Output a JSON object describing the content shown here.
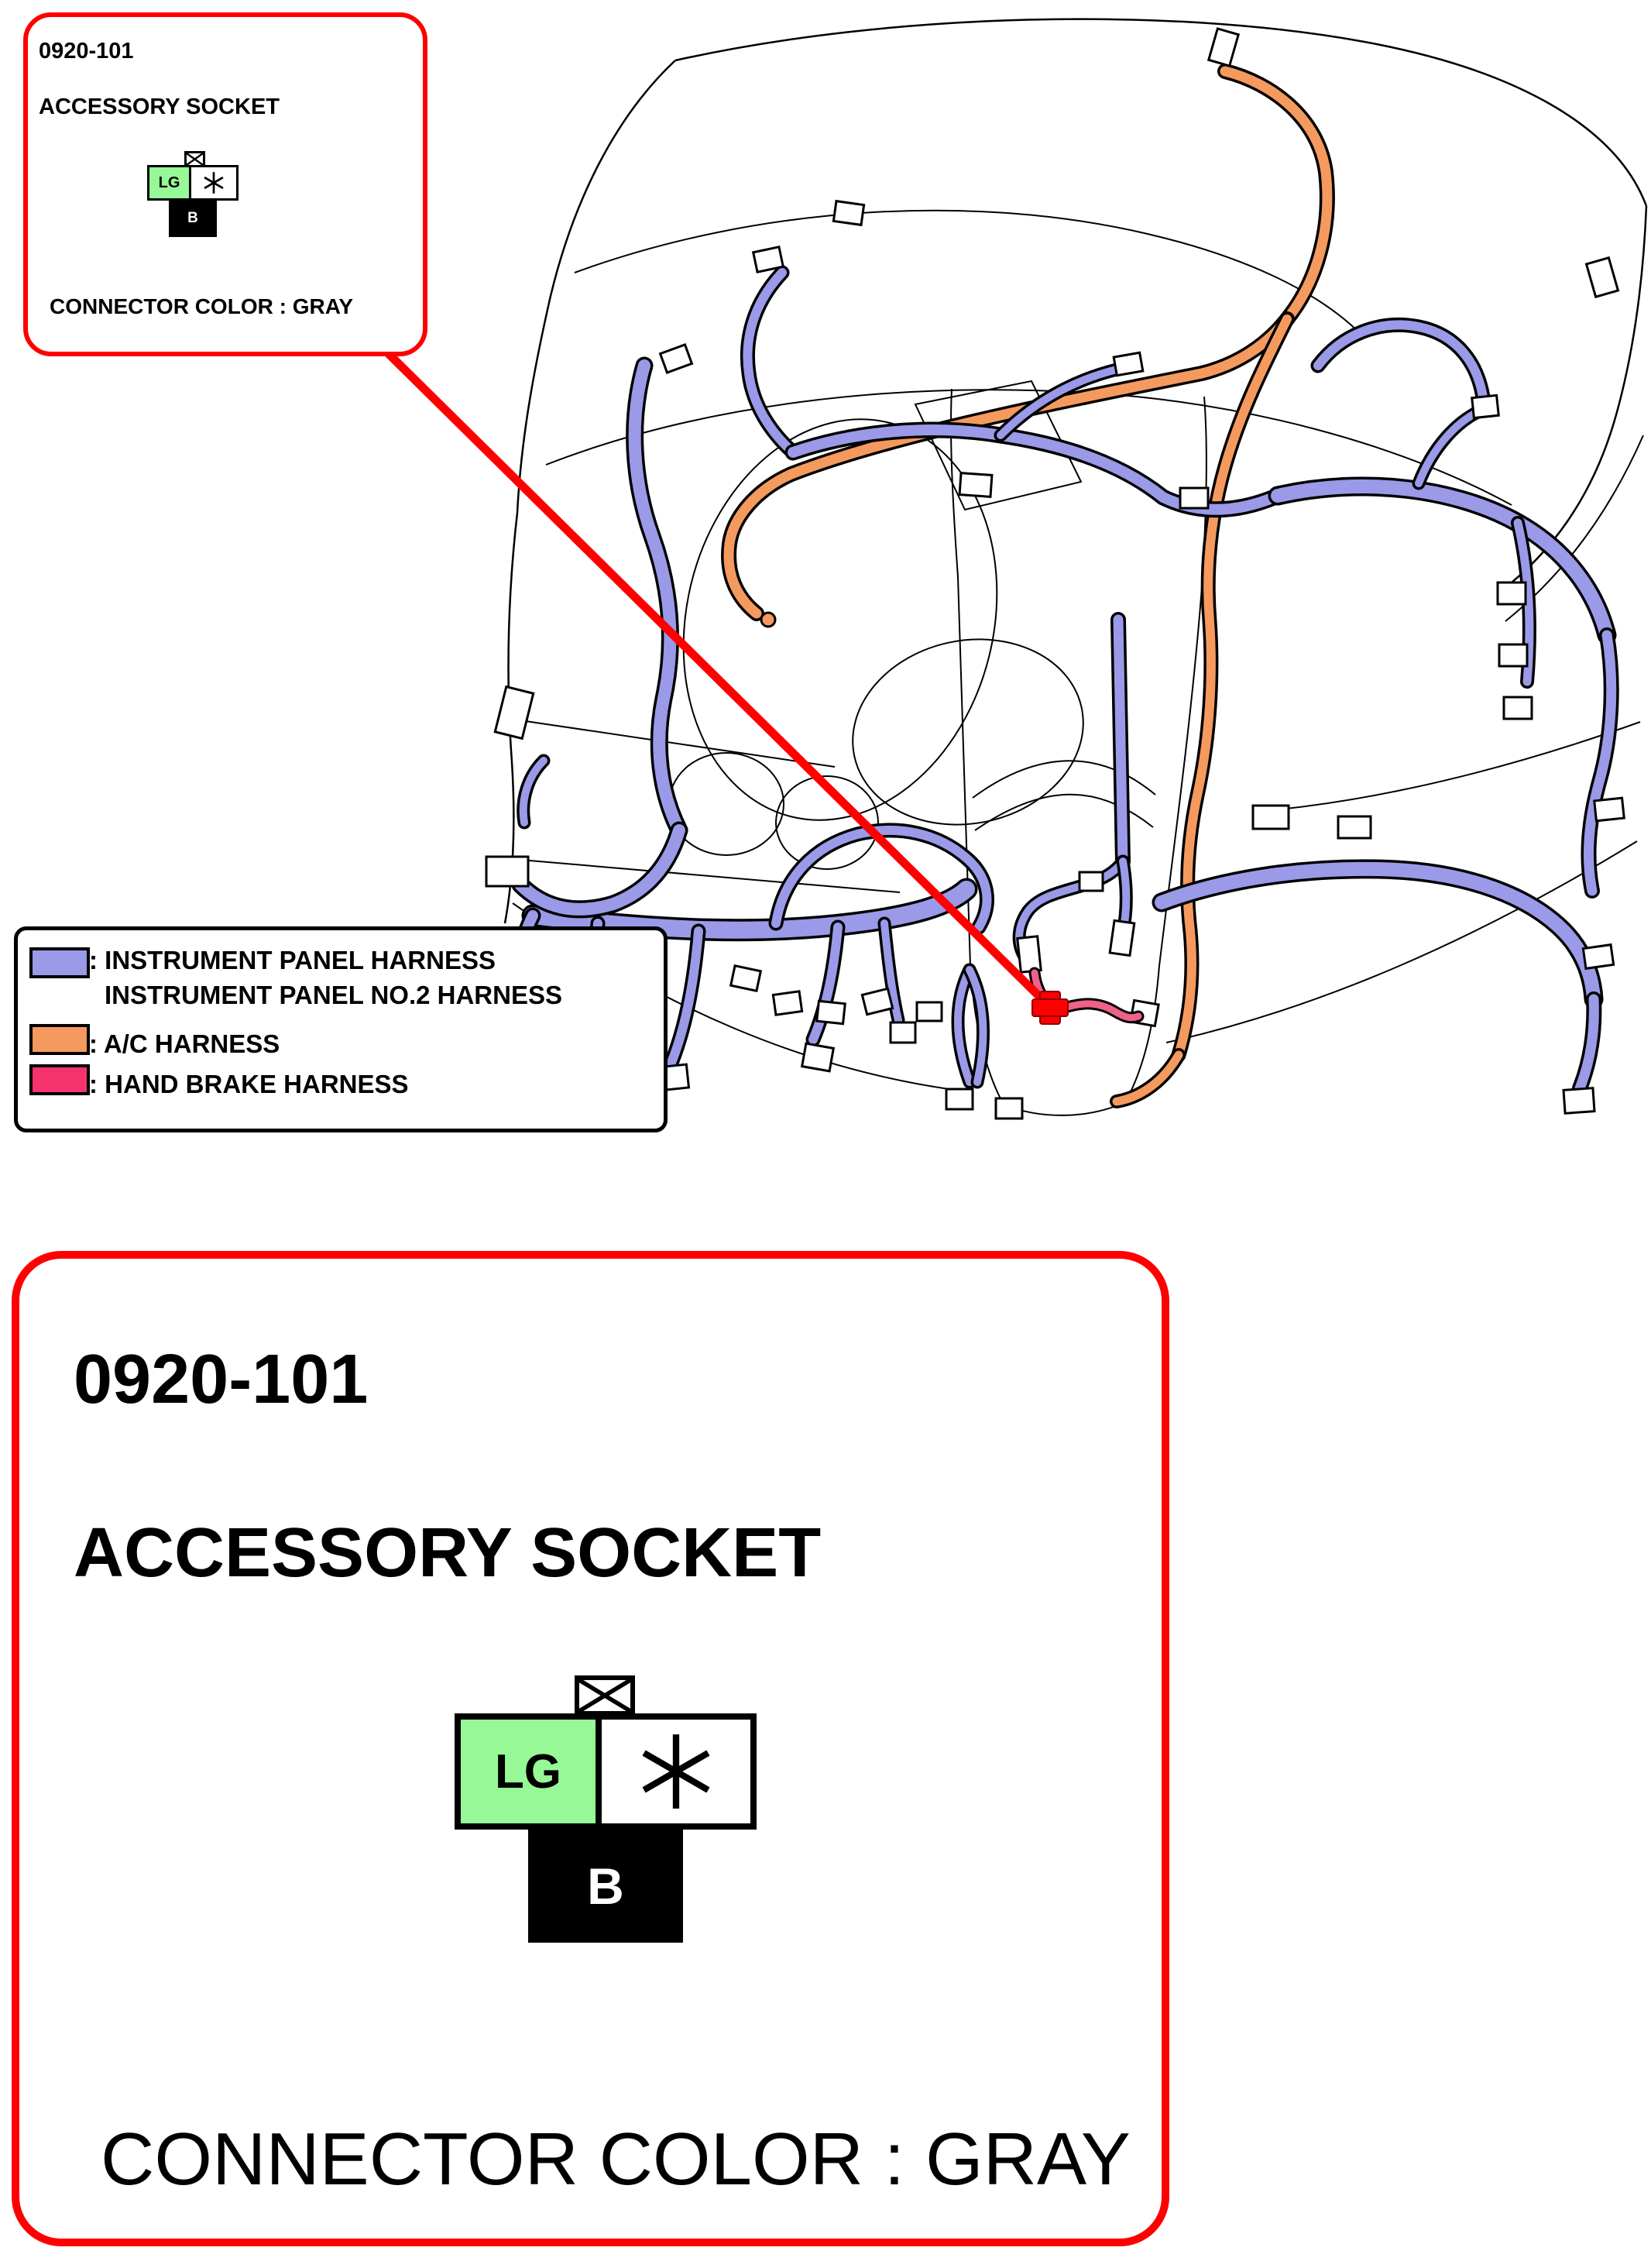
{
  "colors": {
    "callout_red": "#FF0000",
    "ip_harness": "#9A9AE8",
    "ac_harness": "#F59A5E",
    "hand_brake_line": "#EE6288",
    "hand_brake_swatch": "#F4336E",
    "pin_green": "#97F897",
    "outline": "#000000"
  },
  "callout": {
    "code": "0920-101",
    "name": "ACCESSORY SOCKET",
    "color_note": "CONNECTOR COLOR : GRAY",
    "pins": {
      "left": "LG",
      "right": "*",
      "bottom": "B"
    }
  },
  "legend": {
    "items": [
      {
        "swatch_color": "#9A9AE8",
        "line1": ": INSTRUMENT PANEL HARNESS",
        "line2": "INSTRUMENT PANEL NO.2 HARNESS"
      },
      {
        "swatch_color": "#F59A5E",
        "line1": ": A/C HARNESS"
      },
      {
        "swatch_color": "#F4336E",
        "line1": ": HAND BRAKE HARNESS"
      }
    ]
  }
}
